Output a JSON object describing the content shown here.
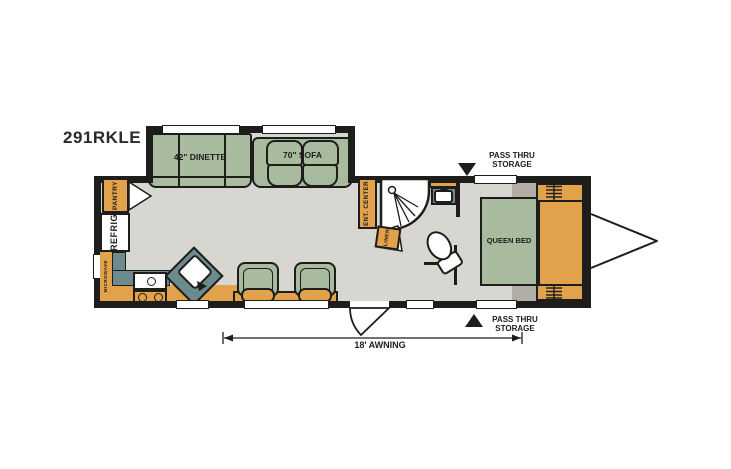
{
  "title": "291RKLE",
  "colors": {
    "wall": "#1d1d1b",
    "floor": "#d8d6d0",
    "furniture_green": "#a8bb9e",
    "cabinet_orange": "#e2a14b",
    "counter_teal": "#6d8a8d",
    "storage_gray": "#b2aea7",
    "background": "#ffffff"
  },
  "labels": {
    "dinette": "42\" DINETTE",
    "sofa": "70\" SOFA",
    "pantry": "PANTRY",
    "refrigerator": "REFRIG",
    "microwave": "MICROWAVE",
    "ent_center": "ENT. CENTER",
    "linen": "LINEN",
    "queen_bed": "QUEEN BED",
    "awning": "18' AWNING",
    "pass_thru_line1": "PASS THRU",
    "pass_thru_line2": "STORAGE"
  }
}
